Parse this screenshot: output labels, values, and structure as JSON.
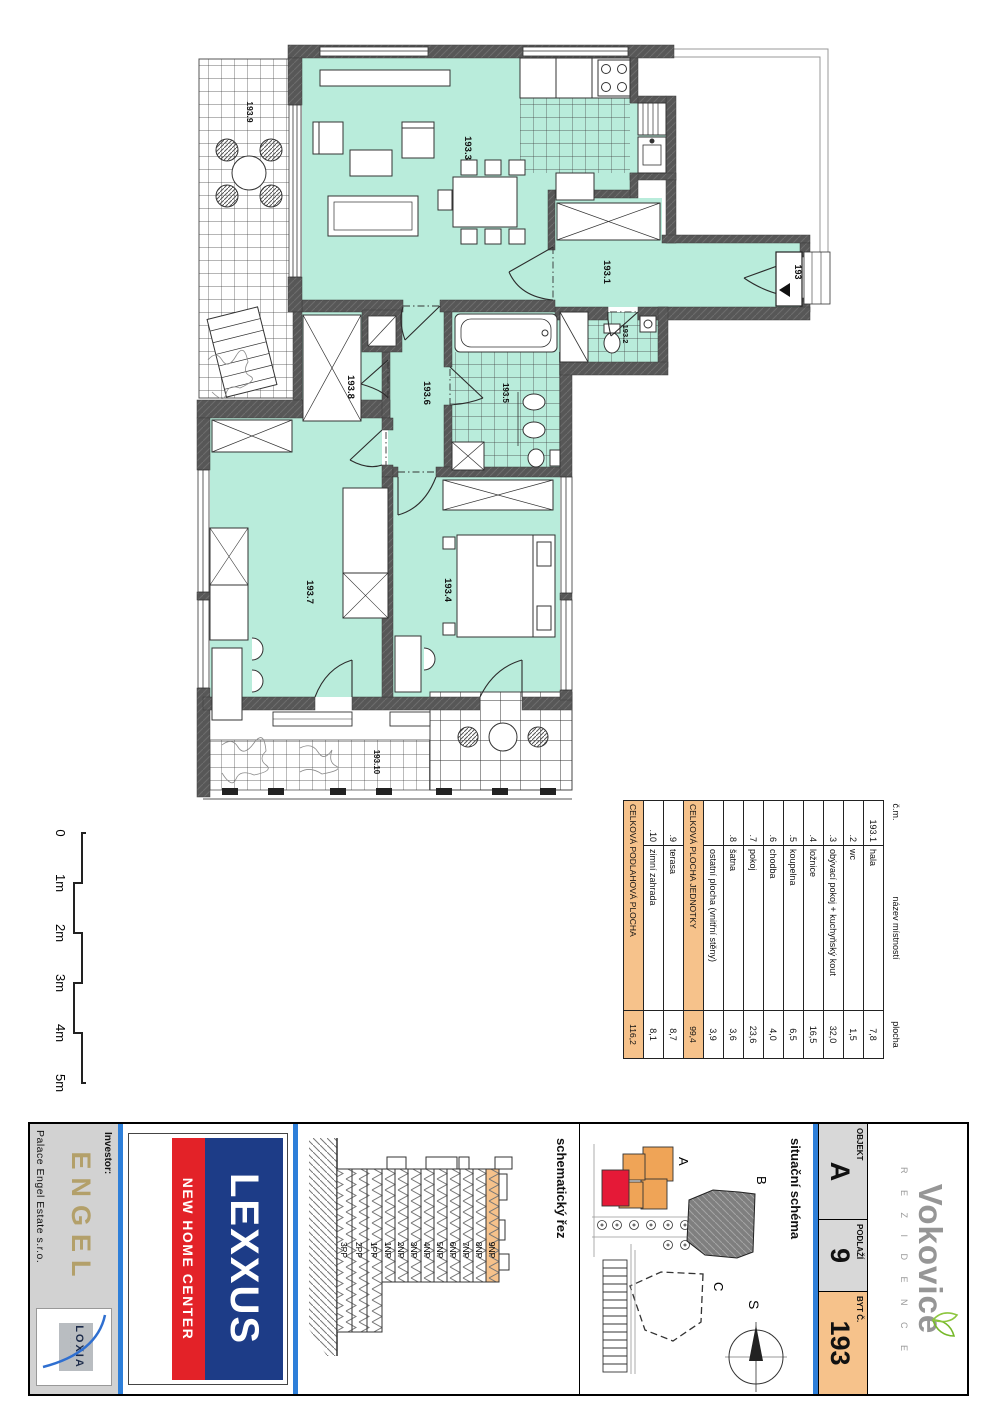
{
  "plan": {
    "labels": {
      "r1": "193.1",
      "r2": "193.2",
      "r3": "193.3",
      "r4": "193.4",
      "r5": "193.5",
      "r6": "193.6",
      "r7": "193.7",
      "r8": "193.8",
      "r9": "193.9",
      "r10": "193.10",
      "entry": "193"
    }
  },
  "scale_bar": {
    "labels": [
      "0",
      "1m",
      "2m",
      "3m",
      "4m",
      "5m"
    ]
  },
  "room_table": {
    "headers": {
      "num": "č.m.",
      "name": "název místností",
      "area": "plocha"
    },
    "rows": [
      {
        "num": "193.1",
        "name": "hala",
        "area": "7,8"
      },
      {
        "num": ".2",
        "name": "wc",
        "area": "1,5"
      },
      {
        "num": ".3",
        "name": "obývací pokoj + kuchyňský kout",
        "area": "32,0"
      },
      {
        "num": ".4",
        "name": "ložnice",
        "area": "16,5"
      },
      {
        "num": ".5",
        "name": "koupelna",
        "area": "6,5"
      },
      {
        "num": ".6",
        "name": "chodba",
        "area": "4,0"
      },
      {
        "num": ".7",
        "name": "pokoj",
        "area": "23,6"
      },
      {
        "num": ".8",
        "name": "šatna",
        "area": "3,6"
      },
      {
        "num": "",
        "name": "ostatní plocha (vnitřní stěny)",
        "area": "3,9"
      },
      {
        "num": "",
        "name": "CELKOVÁ PLOCHA JEDNOTKY",
        "area": "99,4"
      },
      {
        "num": ".9",
        "name": "terasa",
        "area": "8,7"
      },
      {
        "num": ".10",
        "name": "zimní zahrada",
        "area": "8,1"
      },
      {
        "num": "",
        "name": "CELKOVÁ PODLAHOVÁ PLOCHA",
        "area": "116,2"
      }
    ]
  },
  "title_block": {
    "brand": {
      "name": "Vokovice",
      "subtitle": "R E Z I D E N C E"
    },
    "id_cells": [
      {
        "label": "OBJEKT",
        "value": "A"
      },
      {
        "label": "PODLAŽÍ",
        "value": "9"
      },
      {
        "label": "BYT Č.",
        "value": "193"
      }
    ],
    "site_scheme": {
      "title": "situační schéma",
      "building_a": "A",
      "building_b": "B",
      "building_c": "C",
      "compass": "S"
    },
    "section_cut": {
      "title": "schematický řez",
      "floors": [
        "9NP",
        "8NP",
        "7NP",
        "6NP",
        "5NP",
        "4NP",
        "3NP",
        "2NP",
        "1NP",
        "1PP",
        "2PP",
        "3PP"
      ]
    },
    "lexxus": {
      "name": "LEXXUS",
      "tagline": "NEW HOME CENTER"
    },
    "investor": {
      "label": "Investor:",
      "logo": "ENGEL",
      "company": "Palace Engel Estate s.r.o.",
      "partner": "LOXIA"
    }
  },
  "colors": {
    "room_fill": "#b9ecdb",
    "wall": "#575757",
    "highlight_orange": "#f6c28b",
    "blue_rule": "#2e7fd9",
    "lexxus_navy": "#1d3c87",
    "lexxus_red": "#e32228",
    "engel_gold": "#b3a06a",
    "vokovice_gray": "#969696",
    "vokovice_green": "#76b82a",
    "site_unit_red": "#e51937"
  }
}
